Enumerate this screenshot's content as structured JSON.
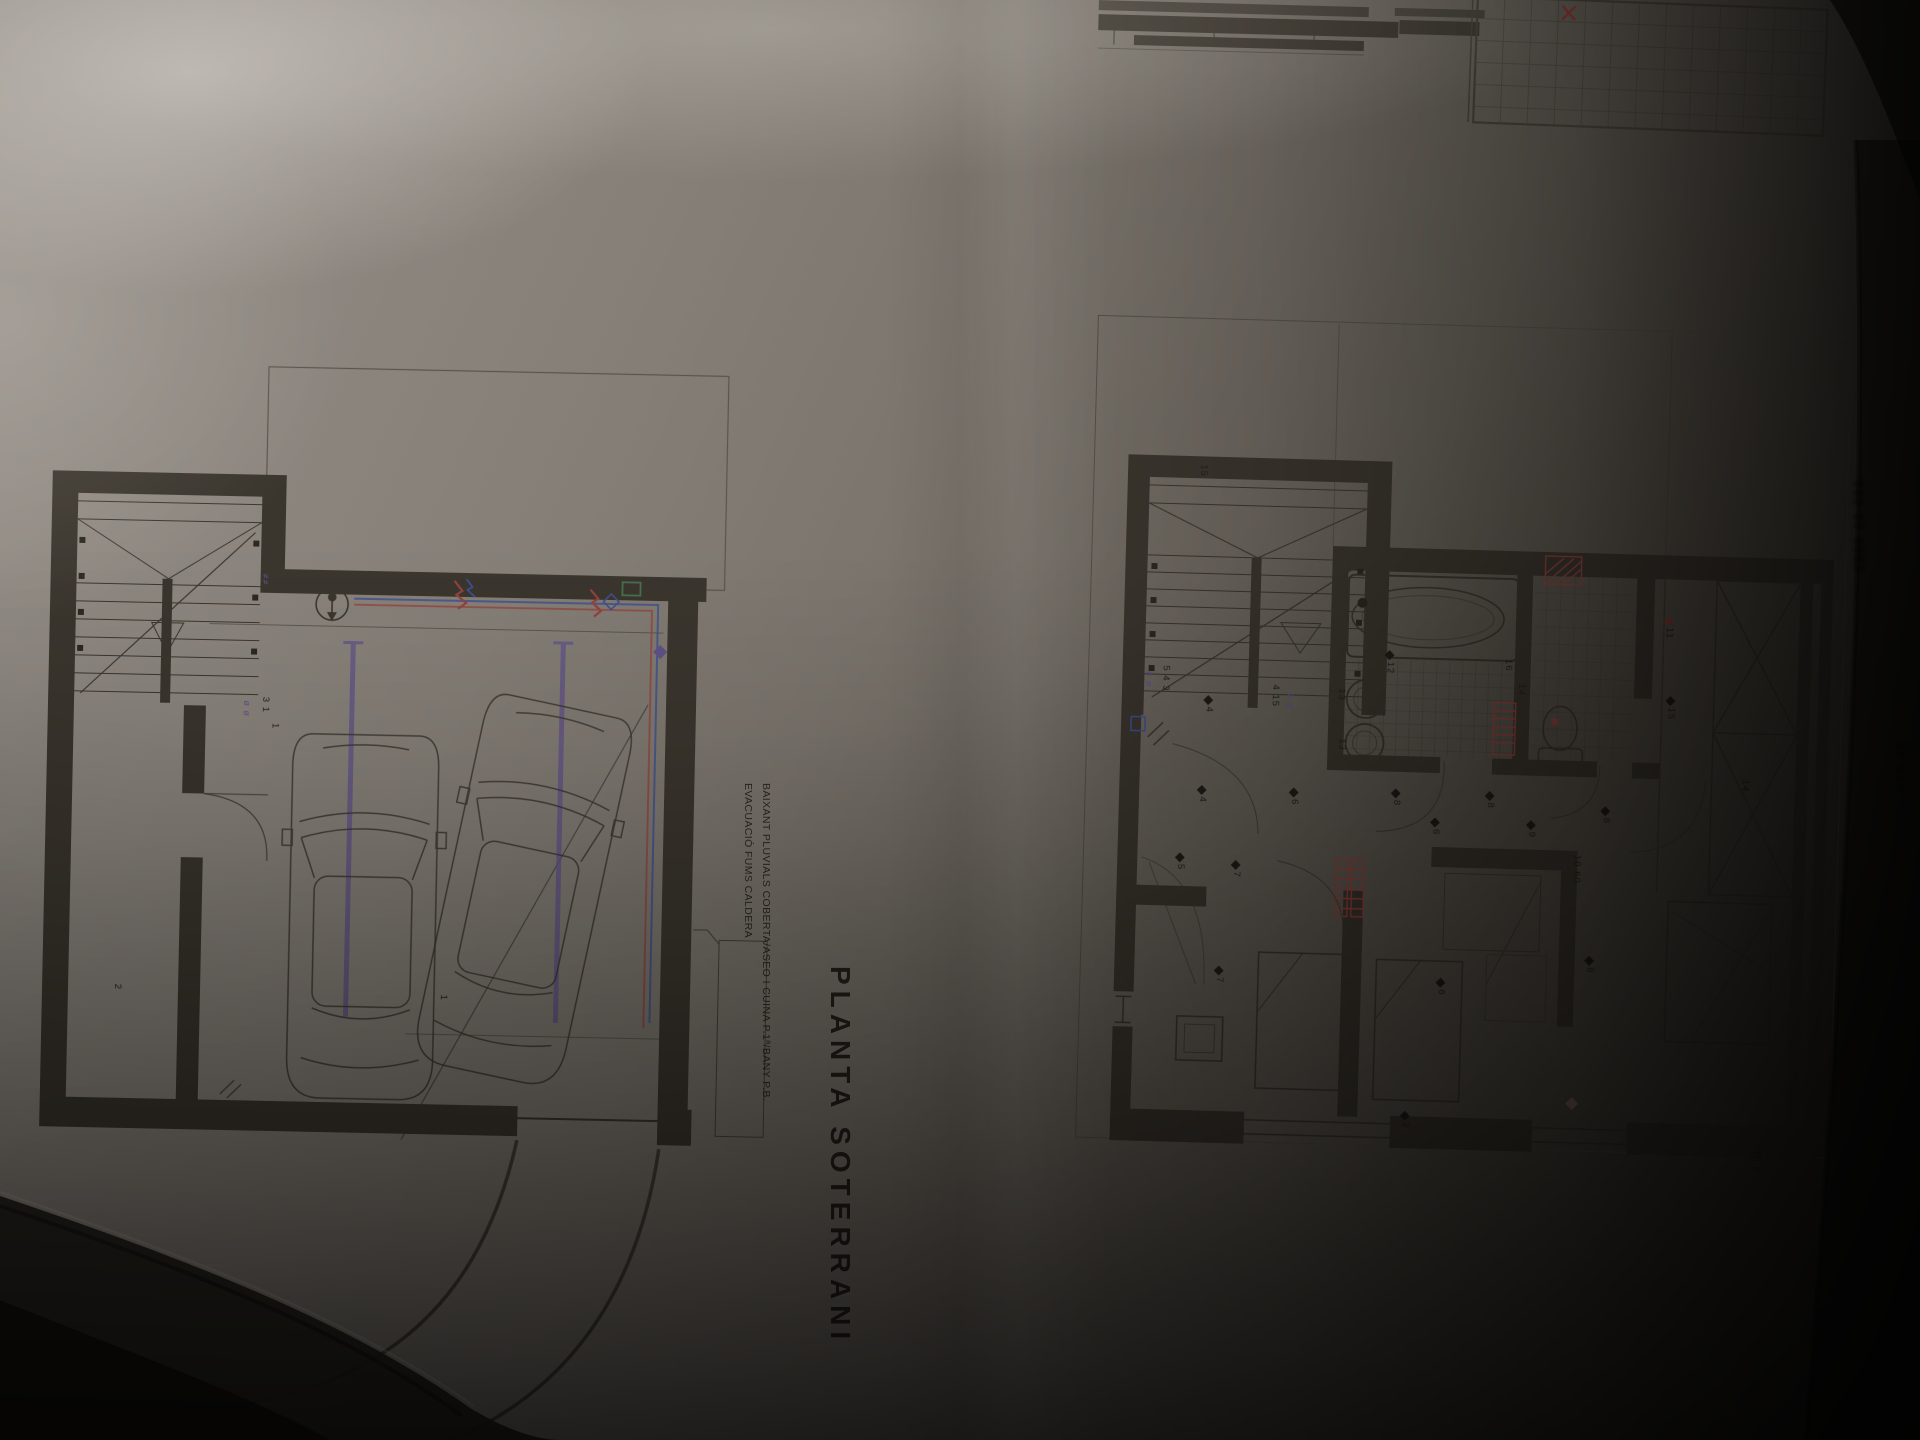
{
  "photo": {
    "background_color": "#14110d",
    "paper_color": "#8a847b",
    "description_colors": {
      "ink": "#3a352d",
      "purple": "#5f5288",
      "red": "#93423c",
      "blue": "#3f4f8e",
      "green": "#47714c"
    }
  },
  "sheet_left": {
    "title": "PLANTA SOTERRANI",
    "annotation_1": "EVACUACIÓ FUMS CALDERA",
    "annotation_2": "BAIXANT PLUVIALS COBERTA/ASEO I CUINA P.1ª/BANY P.B.",
    "labels": [
      {
        "text": "3 1",
        "x": 238,
        "y": 372,
        "kind": "dim"
      },
      {
        "text": "ø ø",
        "x": 220,
        "y": 376,
        "kind": "sym"
      },
      {
        "text": "≠≠",
        "x": 236,
        "y": 249,
        "kind": "sym"
      },
      {
        "text": "1",
        "x": 248,
        "y": 398,
        "kind": "dim"
      },
      {
        "text": "1",
        "x": 422,
        "y": 666,
        "kind": "dim"
      },
      {
        "text": "2",
        "x": 96,
        "y": 662,
        "kind": "dim"
      }
    ]
  },
  "sheet_right": {
    "markers": [
      {
        "text": "15",
        "x": 128,
        "y": 166,
        "kind": "dim"
      },
      {
        "text": "5 4 3",
        "x": 96,
        "y": 368,
        "kind": "dim"
      },
      {
        "text": "ø ø",
        "x": 80,
        "y": 374,
        "kind": "sym"
      },
      {
        "text": "4 15",
        "x": 206,
        "y": 384,
        "kind": "dim"
      },
      {
        "text": "ø ø",
        "x": 222,
        "y": 392,
        "kind": "sym"
      },
      {
        "text": "4",
        "x": 140,
        "y": 398,
        "kind": "d"
      },
      {
        "text": "12",
        "x": 320,
        "y": 348,
        "kind": "d"
      },
      {
        "text": "13",
        "x": 272,
        "y": 386,
        "kind": "dim"
      },
      {
        "text": "13",
        "x": 274,
        "y": 436,
        "kind": "dim"
      },
      {
        "text": "16",
        "x": 438,
        "y": 352,
        "kind": "dim"
      },
      {
        "text": "14",
        "x": 452,
        "y": 376,
        "kind": "dim"
      },
      {
        "text": "11",
        "x": 598,
        "y": 306,
        "kind": "dr"
      },
      {
        "text": "15",
        "x": 602,
        "y": 386,
        "kind": "d"
      },
      {
        "text": "4",
        "x": 136,
        "y": 488,
        "kind": "d"
      },
      {
        "text": "6",
        "x": 228,
        "y": 488,
        "kind": "d"
      },
      {
        "text": "8",
        "x": 330,
        "y": 486,
        "kind": "d"
      },
      {
        "text": "8",
        "x": 424,
        "y": 486,
        "kind": "d"
      },
      {
        "text": "6",
        "x": 370,
        "y": 514,
        "kind": "d"
      },
      {
        "text": "9",
        "x": 466,
        "y": 514,
        "kind": "d"
      },
      {
        "text": "10 60",
        "x": 512,
        "y": 546,
        "kind": "dim"
      },
      {
        "text": "8",
        "x": 540,
        "y": 498,
        "kind": "d"
      },
      {
        "text": "5",
        "x": 116,
        "y": 556,
        "kind": "d"
      },
      {
        "text": "7",
        "x": 172,
        "y": 562,
        "kind": "d"
      },
      {
        "text": "7",
        "x": 158,
        "y": 668,
        "kind": "d"
      },
      {
        "text": "6",
        "x": 380,
        "y": 674,
        "kind": "d"
      },
      {
        "text": "8",
        "x": 528,
        "y": 648,
        "kind": "d"
      },
      {
        "text": "2",
        "x": 348,
        "y": 808,
        "kind": "d"
      },
      {
        "text": "14",
        "x": 678,
        "y": 466,
        "kind": "dim"
      },
      {
        "text": "15 2",
        "x": 700,
        "y": 836,
        "kind": "dim"
      }
    ]
  },
  "margin_notes": [
    {
      "text": "▮▮▮ ▮▮ ▮▮▮▮",
      "x": 1868,
      "y": 480
    },
    {
      "text": "▮▮ ▮▮▮",
      "x": 1910,
      "y": 742
    }
  ]
}
